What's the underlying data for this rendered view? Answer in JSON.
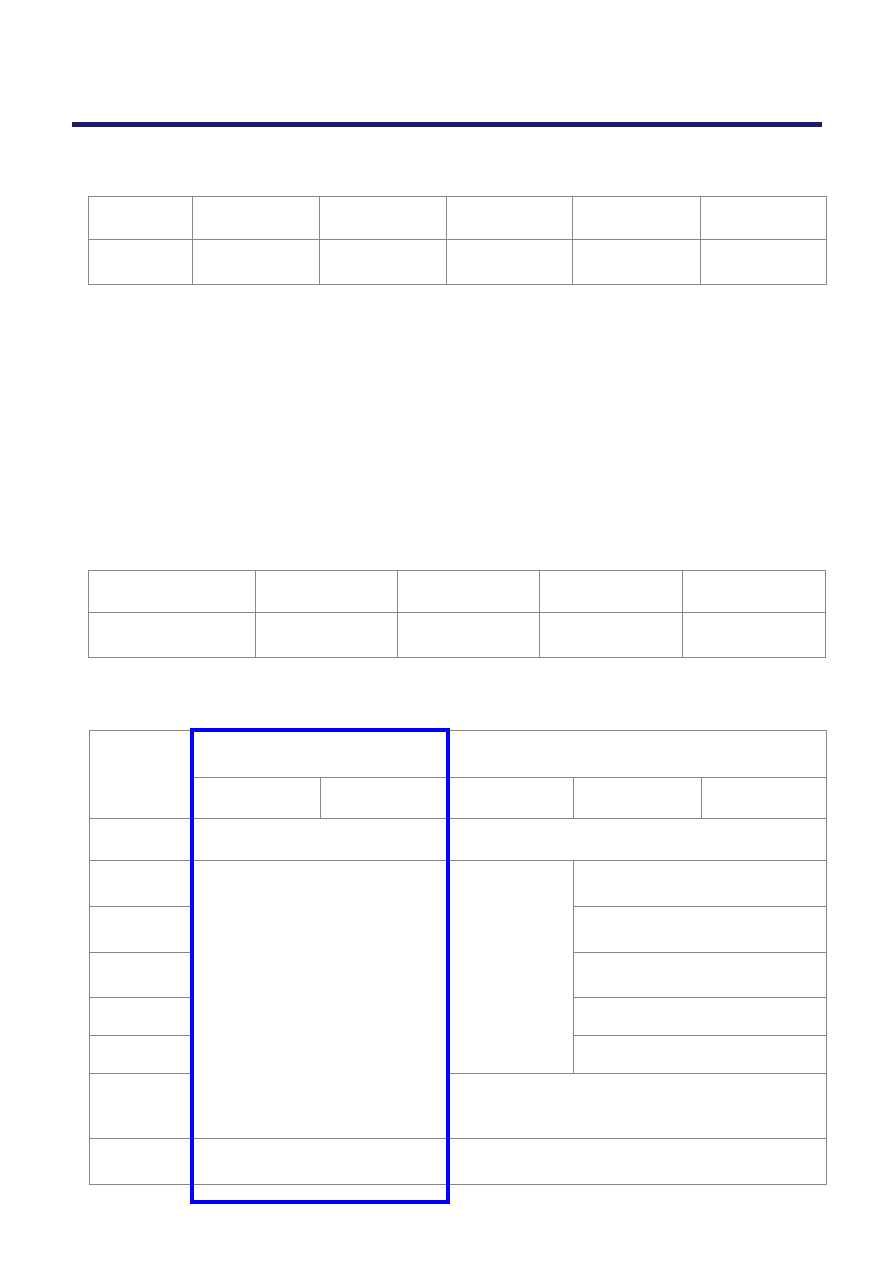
{
  "colors": {
    "page_background": "#FFFFFF",
    "rule": "#1A1A70",
    "table_border": "#878787",
    "highlight": "#0000FF"
  },
  "page": {
    "kind": "blank document page with empty tables",
    "horizontal_rule": {
      "color": "#1A1A70"
    }
  },
  "tables": {
    "top": {
      "columns": 6,
      "rows": 2,
      "all_cells_empty": true
    },
    "middle": {
      "columns": 5,
      "rows": 2,
      "all_cells_empty": true
    },
    "bottom": {
      "columns": 6,
      "rows": 10,
      "all_cells_empty": true,
      "highlighted_region": "columns 2-3 full height"
    }
  },
  "cell_text": ""
}
